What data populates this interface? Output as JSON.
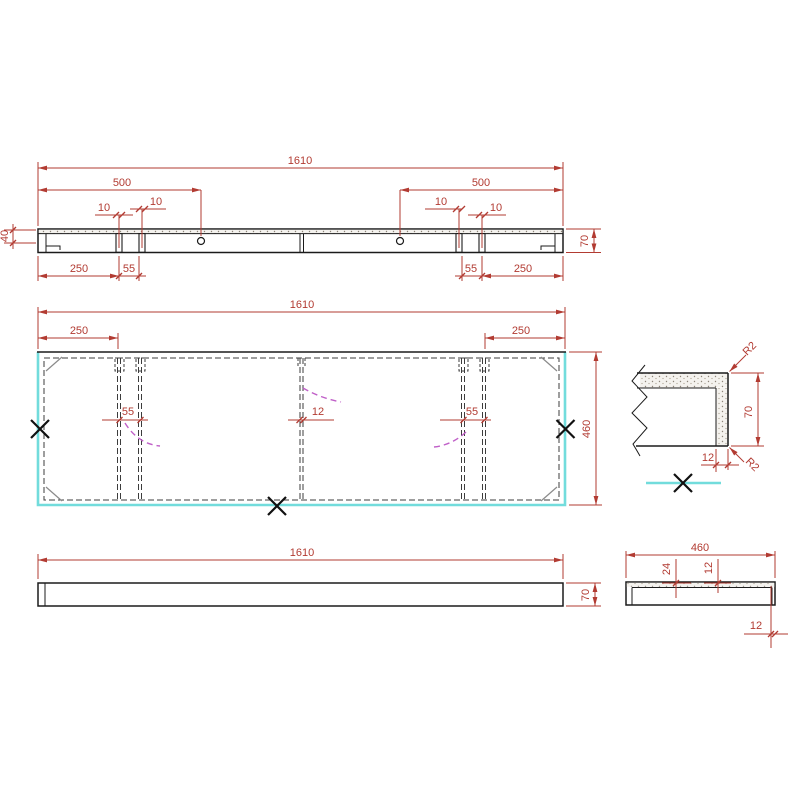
{
  "background": "#ffffff",
  "colors": {
    "outline": "#1b1b1b",
    "dimension": "#b23b32",
    "highlight_cyan": "#72dcdc",
    "arc_magenta": "#c060c8",
    "chamfer_gray": "#8a8a8a",
    "hidden_dash": "#3c3c3c"
  },
  "views": {
    "section": {
      "name": "top horizontal section view",
      "overall_length": "1610",
      "hole_offset_left": "500",
      "hole_offset_right": "500",
      "slot_width_1": "10",
      "slot_width_2": "10",
      "slot_width_3": "10",
      "slot_width_4": "10",
      "end_offset_left": "250",
      "slot_gap_left": "55",
      "slot_gap_right": "55",
      "end_offset_right": "250",
      "thickness": "70",
      "end_inset": "40"
    },
    "plan": {
      "name": "plan view",
      "overall_length": "1610",
      "end_offset_left": "250",
      "end_offset_right": "250",
      "divider_gap_left": "55",
      "divider_width": "12",
      "divider_gap_right": "55",
      "depth": "460"
    },
    "corner_detail": {
      "name": "corner detail view",
      "radius_top": "R2",
      "radius_bottom": "R2",
      "height": "70",
      "skin_thickness": "12"
    },
    "front": {
      "name": "front elevation view",
      "overall_length": "1610",
      "thickness": "70"
    },
    "side": {
      "name": "side elevation view",
      "depth": "460",
      "edge_height": "24",
      "skin_thickness": "12",
      "band_thickness": "12"
    }
  }
}
